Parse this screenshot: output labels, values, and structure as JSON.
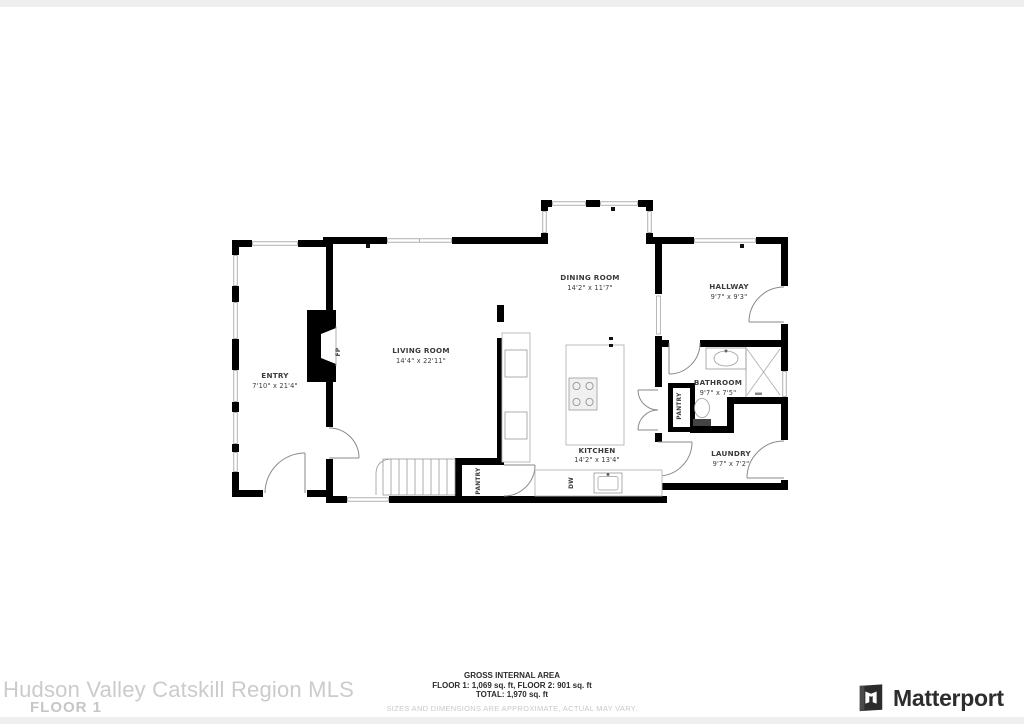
{
  "plan": {
    "rooms": {
      "entry": {
        "name": "ENTRY",
        "dims": "7'10\" x 21'4\""
      },
      "living": {
        "name": "LIVING ROOM",
        "dims": "14'4\" x 22'11\""
      },
      "dining": {
        "name": "DINING ROOM",
        "dims": "14'2\" x 11'7\""
      },
      "hallway": {
        "name": "HALLWAY",
        "dims": "9'7\" x 9'3\""
      },
      "bathroom": {
        "name": "BATHROOM",
        "dims": "9'7\" x 7'5\""
      },
      "laundry": {
        "name": "LAUNDRY",
        "dims": "9'7\" x 7'2\""
      },
      "kitchen": {
        "name": "KITCHEN",
        "dims": "14'2\" x 13'4\""
      }
    },
    "fixtures": {
      "pantry_kitchen": "PANTRY",
      "pantry_hall": "PANTRY",
      "dishwasher": "DW",
      "fireplace": "FP"
    }
  },
  "footer": {
    "title": "GROSS INTERNAL AREA",
    "areas": "FLOOR 1: 1,069 sq. ft, FLOOR 2: 901 sq. ft",
    "total": "TOTAL: 1,970 sq. ft",
    "disclaimer": "SIZES AND DIMENSIONS ARE APPROXIMATE, ACTUAL MAY VARY."
  },
  "watermark": {
    "mls": "Hudson Valley Catskill Region MLS",
    "floor": "FLOOR 1"
  },
  "brand": {
    "wordmark": "Matterport"
  },
  "colors": {
    "wall": "#000000",
    "fixture_line": "#9a9a9a",
    "label_text": "#3b3b3b",
    "watermark_text": "#c9c9c9",
    "footer_text": "#2b2b2b",
    "disclaimer_text": "#c9c9c9",
    "brand_text": "#2d2d2d"
  }
}
